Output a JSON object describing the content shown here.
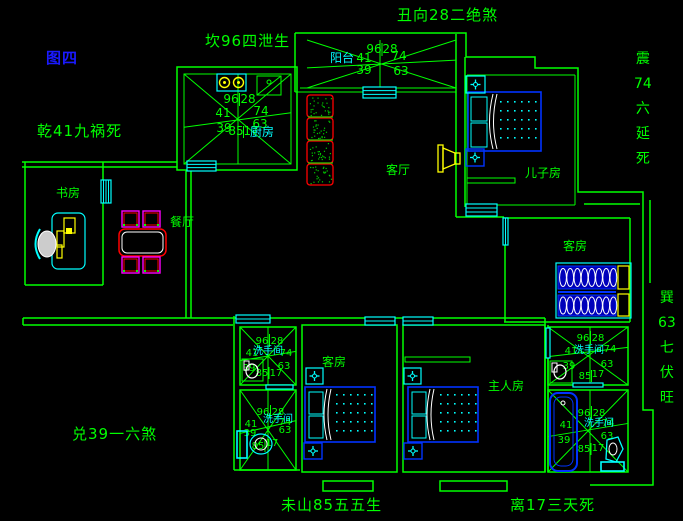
{
  "figure": {
    "label": "图四"
  },
  "annotations": {
    "top": "丑向28二绝煞",
    "top_left": "坎96四泄生",
    "left": "乾41九祸死",
    "bottom_left": "兑39一六煞",
    "bottom_center": "未山85五五生",
    "bottom_right": "离17三天死",
    "right_upper": [
      "震",
      "74",
      "六",
      "延",
      "死"
    ],
    "right_lower": [
      "巽",
      "63",
      "七",
      "伏",
      "旺"
    ]
  },
  "rooms": {
    "kitchen": "厨房",
    "balcony": "阳台",
    "living": "客厅",
    "son_room": "儿子房",
    "guest_room_right": "客房",
    "dining": "餐厅",
    "study": "书房",
    "guest_room_mid": "客房",
    "master": "主人房",
    "washroom": "洗手间"
  },
  "star_numbers": {
    "tl": "96",
    "tr": "28",
    "l": "41",
    "r": "74",
    "bl": "39",
    "br": "63",
    "b1": "85",
    "b2": "17"
  },
  "colors": {
    "wall_green": "#00ff00",
    "label_cyan": "#00ffff",
    "figure_blue": "#0000ff",
    "furniture_blue": "#0000ff",
    "accent_yellow": "#ffff00",
    "accent_red": "#ff0000",
    "accent_magenta": "#ff00ff"
  }
}
